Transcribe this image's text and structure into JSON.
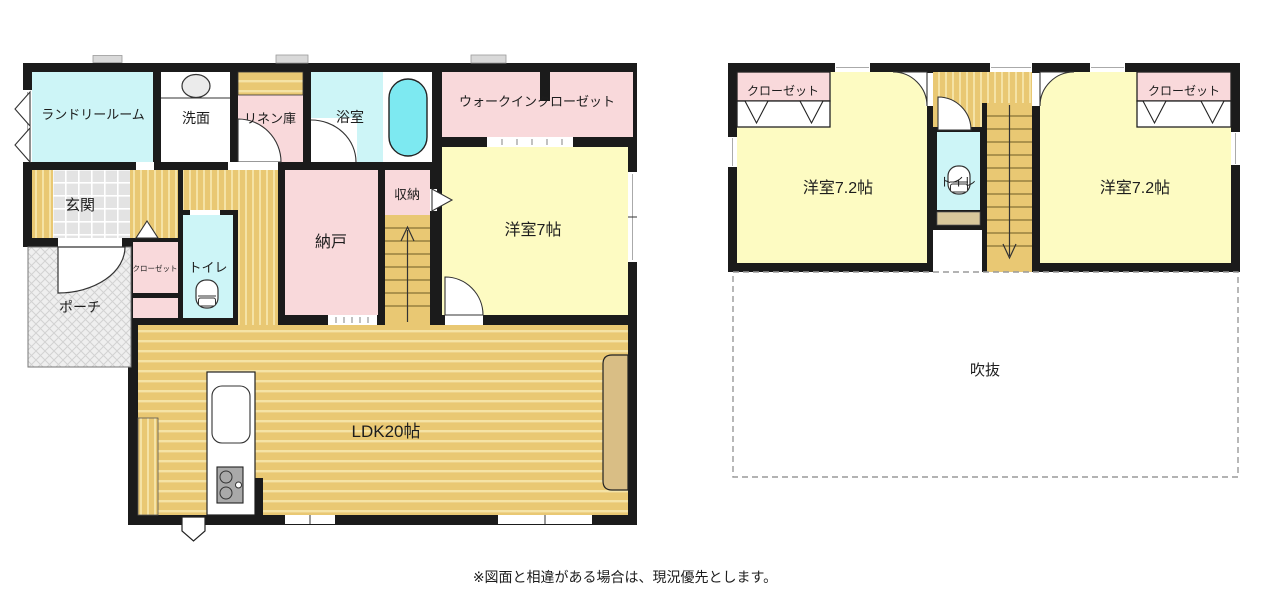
{
  "caption": "※図面と相違がある場合は、現況優先とします。",
  "floor1": {
    "laundry": "ランドリールーム",
    "washroom": "洗面",
    "linen": "リネン庫",
    "bathroom": "浴室",
    "walk_in_closet": "ウォークインクローゼット",
    "bedroom7": "洋室7帖",
    "storage_shuno": "収納",
    "storeroom_nando": "納戸",
    "entrance": "玄関",
    "closet": "クローゼット",
    "toilet": "トイレ",
    "porch": "ポーチ",
    "ldk": "LDK20帖"
  },
  "floor2": {
    "closet_left": "クローゼット",
    "closet_right": "クローゼット",
    "bedroom_left": "洋室7.2帖",
    "bedroom_right": "洋室7.2帖",
    "toilet": "トイレ",
    "void": "吹抜"
  },
  "colors": {
    "wall": "#1b1b1b",
    "cyan_room": "#cdf5f7",
    "pink_room": "#f9d9db",
    "yellow_room": "#fdfbc2",
    "wood_floor": "#e9c873",
    "wood_stripe": "#f5e3a6",
    "bathtub": "#7de9f1",
    "entrance_tile": "#e3e3e3",
    "porch_gray": "#efefef",
    "counter_tan": "#d9be85",
    "shelf_beige": "#d8c79b",
    "sink_gray": "#ebebeb",
    "stove_gray": "#a9a9a9"
  }
}
